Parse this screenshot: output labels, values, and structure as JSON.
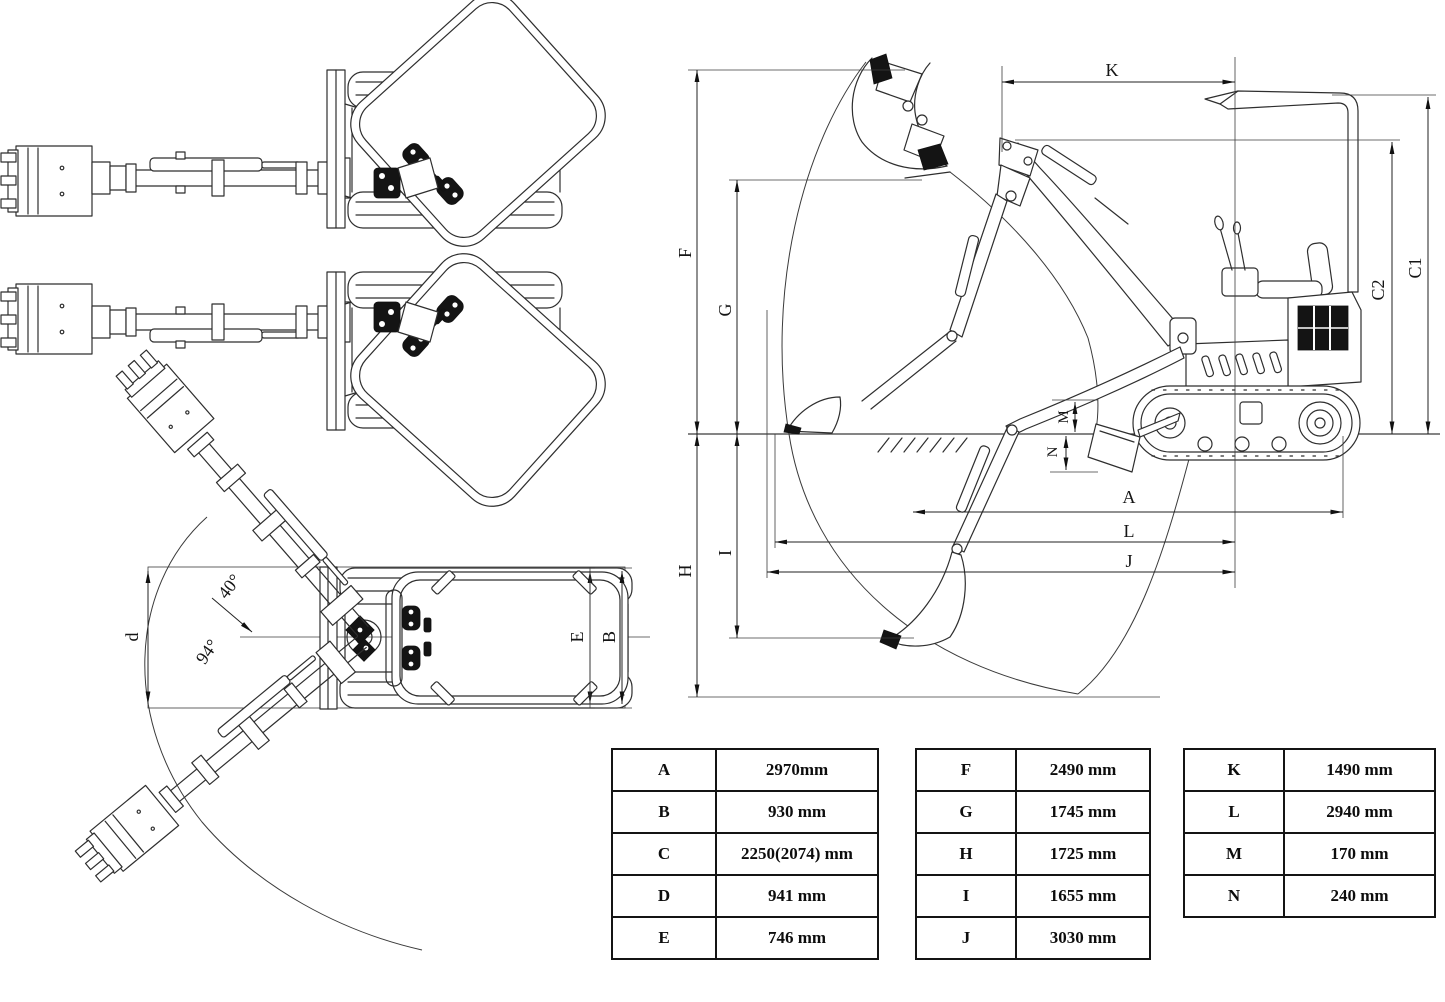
{
  "diagram_title": "mini-excavator dimension drawing",
  "side_view": {
    "labels": {
      "K": "K",
      "C1": "C1",
      "C2": "C2",
      "F": "F",
      "G": "G",
      "H": "H",
      "I": "I",
      "A": "A",
      "L": "L",
      "J": "J",
      "M": "M",
      "N": "N"
    }
  },
  "top_view": {
    "labels": {
      "d": "d",
      "E": "E",
      "B": "B"
    },
    "angles": {
      "upper": "40°",
      "total": "94°"
    }
  },
  "tables": [
    {
      "rows": [
        [
          "A",
          "2970mm"
        ],
        [
          "B",
          "930 mm"
        ],
        [
          "C",
          "2250(2074) mm"
        ],
        [
          "D",
          "941 mm"
        ],
        [
          "E",
          "746 mm"
        ]
      ]
    },
    {
      "rows": [
        [
          "F",
          "2490 mm"
        ],
        [
          "G",
          "1745 mm"
        ],
        [
          "H",
          "1725 mm"
        ],
        [
          "I",
          "1655 mm"
        ],
        [
          "J",
          "3030 mm"
        ]
      ]
    },
    {
      "rows": [
        [
          "K",
          "1490 mm"
        ],
        [
          "L",
          "2940 mm"
        ],
        [
          "M",
          "170 mm"
        ],
        [
          "N",
          "240 mm"
        ]
      ]
    }
  ]
}
